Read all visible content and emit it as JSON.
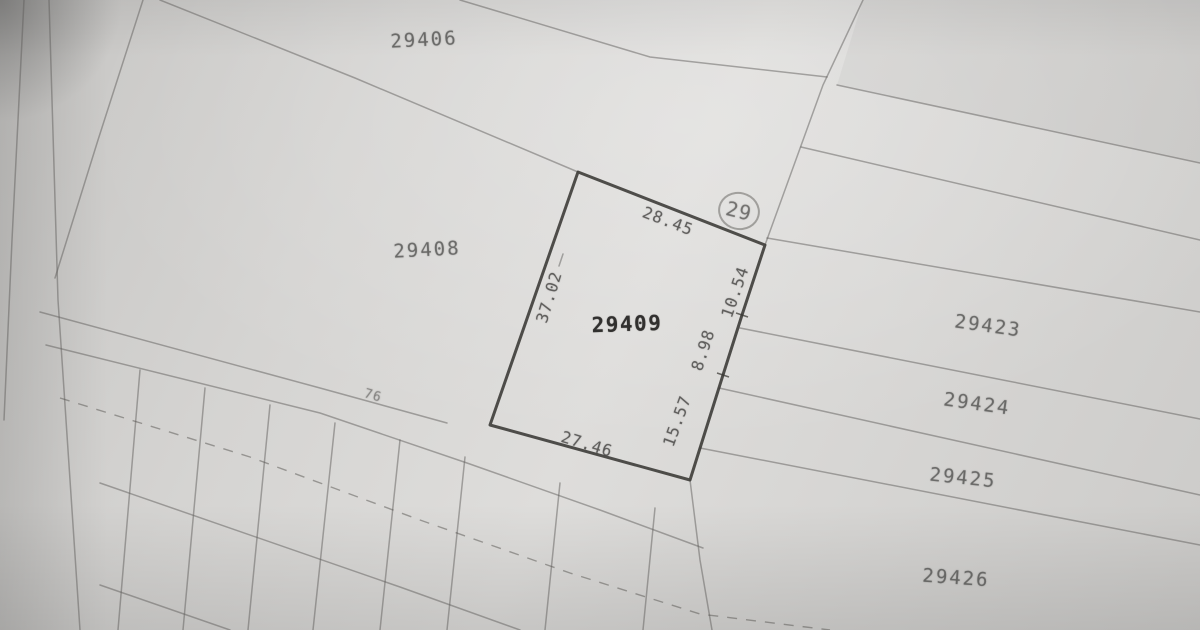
{
  "map": {
    "parcel_labels": [
      {
        "name": "29406",
        "label": "29406"
      },
      {
        "name": "29408",
        "label": "29408"
      },
      {
        "name": "29423",
        "label": "29423"
      },
      {
        "name": "29424",
        "label": "29424"
      },
      {
        "name": "29425",
        "label": "29425"
      },
      {
        "name": "29426",
        "label": "29426"
      }
    ],
    "subject_parcel": {
      "number": "29409",
      "dimensions": {
        "top": "28.45",
        "bottom": "27.46",
        "left": "37.02",
        "right_upper": "10.54",
        "right_middle": "8.98",
        "right_lower": "15.57"
      }
    },
    "corner_marker": {
      "label": "29"
    },
    "road_label": "76",
    "colors": {
      "paper": "#d5d4d2",
      "boundary_line": "#6f6e6c",
      "subject_outline": "#34332f",
      "faint_text": "#6b6a68",
      "subject_text": "#282725"
    }
  }
}
